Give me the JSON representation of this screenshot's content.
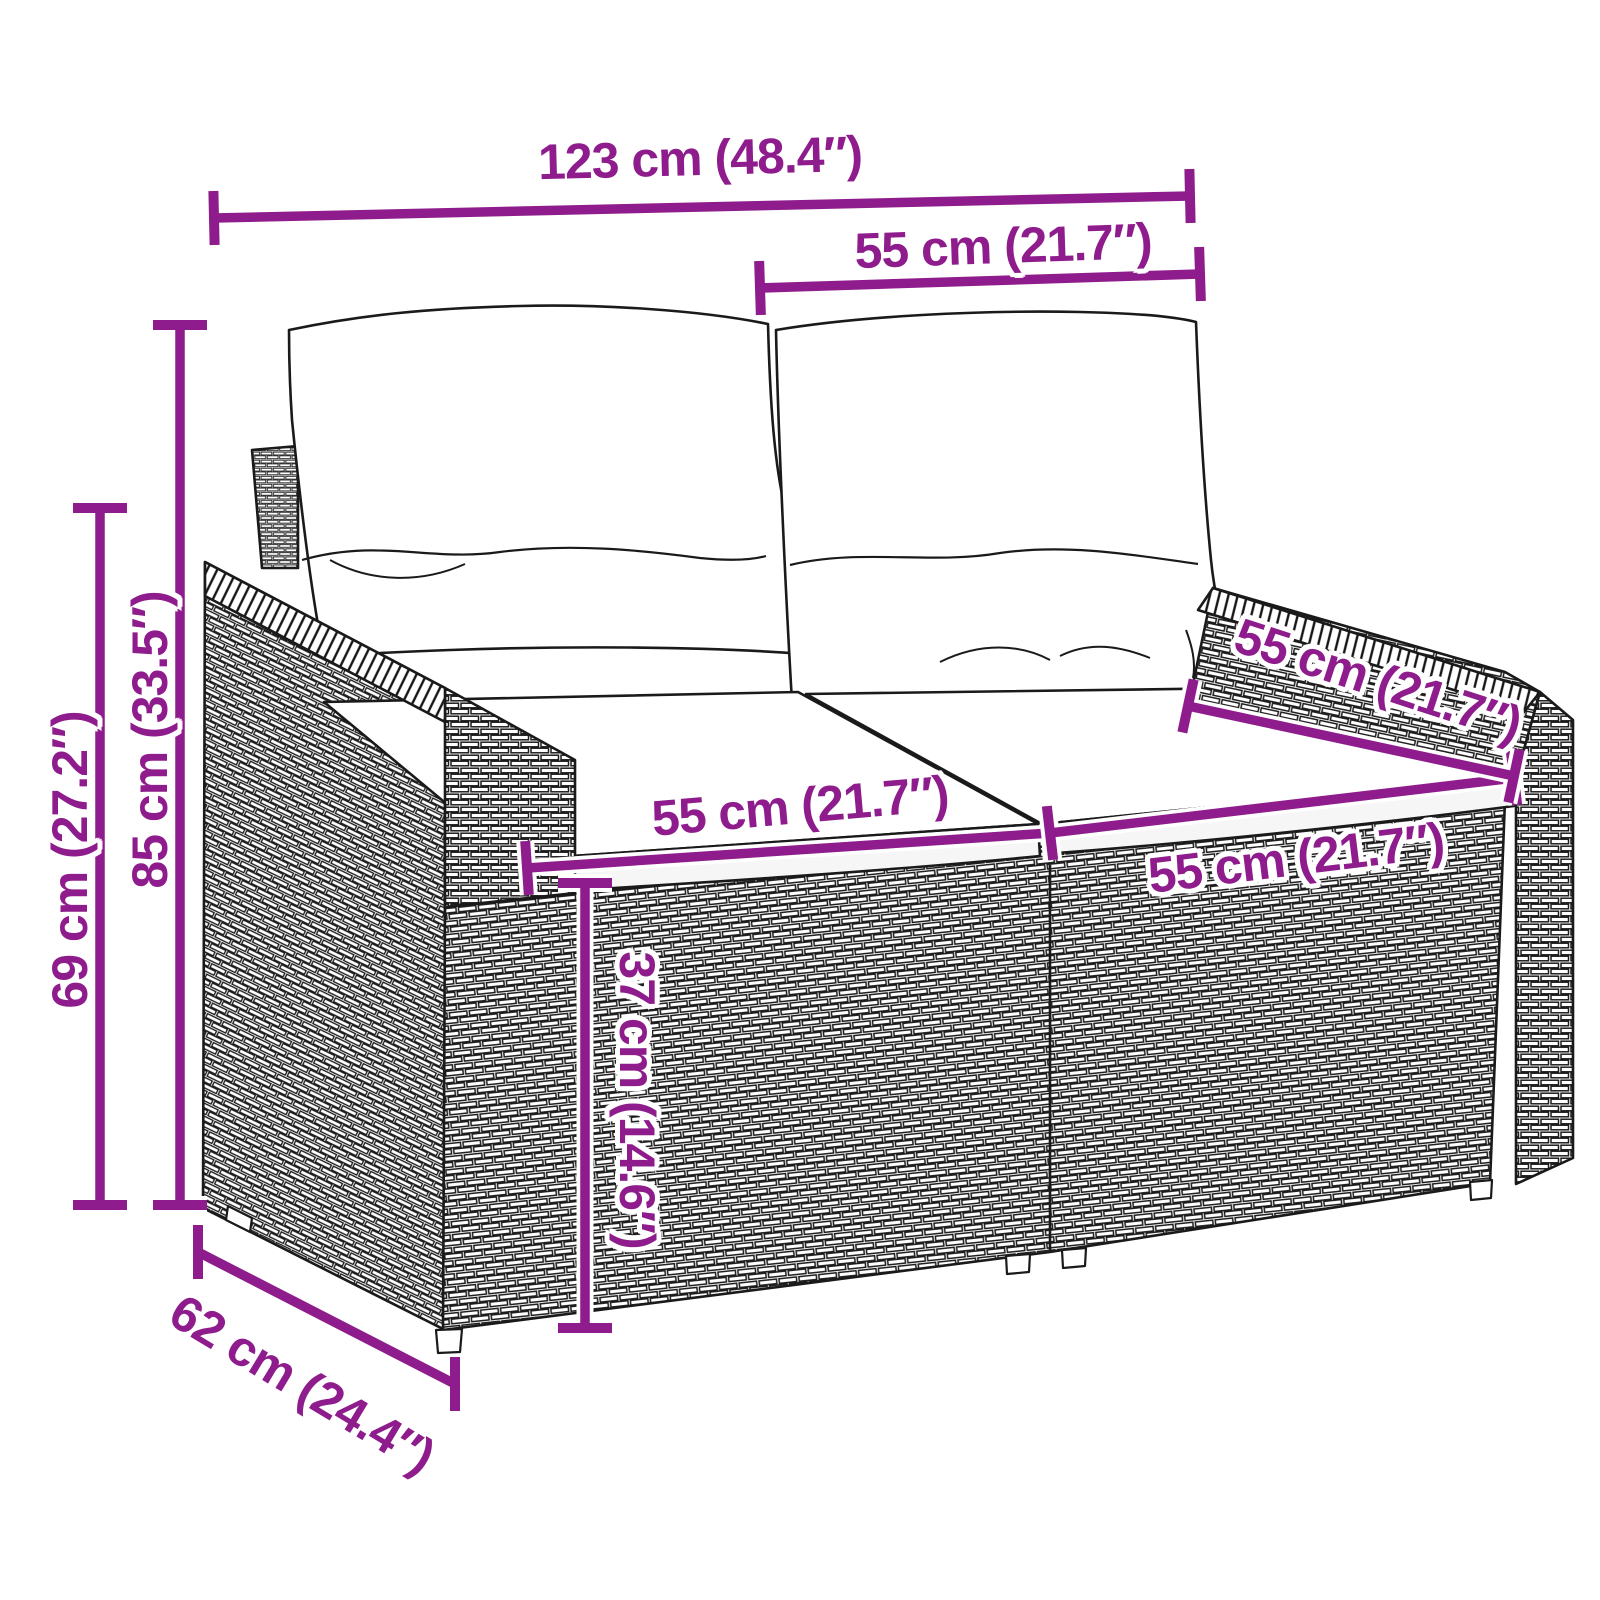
{
  "meta": {
    "product": "rattan-garden-2-seater-sofa-with-cushions",
    "view": "three-quarter line-art dimension diagram"
  },
  "style": {
    "dimension_color": "#8e1c8c",
    "line_art_color": "#1a1a1a",
    "background": "#ffffff"
  },
  "diagram": {
    "annotations": [
      {
        "id": "overall-width",
        "label": "123 cm (48.4″)",
        "line": {
          "x1": 214,
          "y1": 218,
          "x2": 1190,
          "y2": 196
        },
        "tick": "perp",
        "label_pos": {
          "x": 700,
          "y": 158,
          "rot": -1.5
        }
      },
      {
        "id": "backrest-section-width",
        "label": "55 cm (21.7″)",
        "line": {
          "x1": 760,
          "y1": 288,
          "x2": 1200,
          "y2": 274
        },
        "tick": "perp",
        "label_pos": {
          "x": 1003,
          "y": 246,
          "rot": -2
        }
      },
      {
        "id": "overall-height",
        "label": "85 cm (33.5″)",
        "line": {
          "x1": 180,
          "y1": 325,
          "x2": 180,
          "y2": 1205
        },
        "tick": "perp",
        "label_pos": {
          "x": 150,
          "y": 740,
          "rot": -90
        }
      },
      {
        "id": "armrest-height",
        "label": "69 cm (27.2″)",
        "line": {
          "x1": 100,
          "y1": 508,
          "x2": 100,
          "y2": 1205
        },
        "tick": "perp",
        "label_pos": {
          "x": 70,
          "y": 860,
          "rot": -90
        }
      },
      {
        "id": "seat-width-left",
        "label": "55 cm (21.7″)",
        "line": {
          "x1": 527,
          "y1": 868,
          "x2": 1050,
          "y2": 833
        },
        "tick": "perp",
        "label_pos": {
          "x": 800,
          "y": 806,
          "rot": -5
        }
      },
      {
        "id": "seat-width-right",
        "label": "55 cm (21.7″)",
        "line": {
          "x1": 1050,
          "y1": 833,
          "x2": 1514,
          "y2": 778
        },
        "tick": "perp",
        "label_pos": {
          "x": 1296,
          "y": 858,
          "rot": -7
        }
      },
      {
        "id": "seat-depth",
        "label": "55 cm (21.7″)",
        "line": {
          "x1": 1188,
          "y1": 706,
          "x2": 1514,
          "y2": 776
        },
        "tick": "perp",
        "label_pos": {
          "x": 1378,
          "y": 680,
          "rot": 18
        }
      },
      {
        "id": "seat-height",
        "label": "37 cm (14.6″)",
        "line": {
          "x1": 585,
          "y1": 883,
          "x2": 585,
          "y2": 1328
        },
        "tick": "perp",
        "label_pos": {
          "x": 637,
          "y": 1100,
          "rot": 90
        }
      },
      {
        "id": "overall-depth",
        "label": "62 cm (24.4″)",
        "line": {
          "x1": 198,
          "y1": 1252,
          "x2": 455,
          "y2": 1384
        },
        "tick": "vert",
        "label_pos": {
          "x": 302,
          "y": 1384,
          "rot": 31
        }
      }
    ]
  }
}
